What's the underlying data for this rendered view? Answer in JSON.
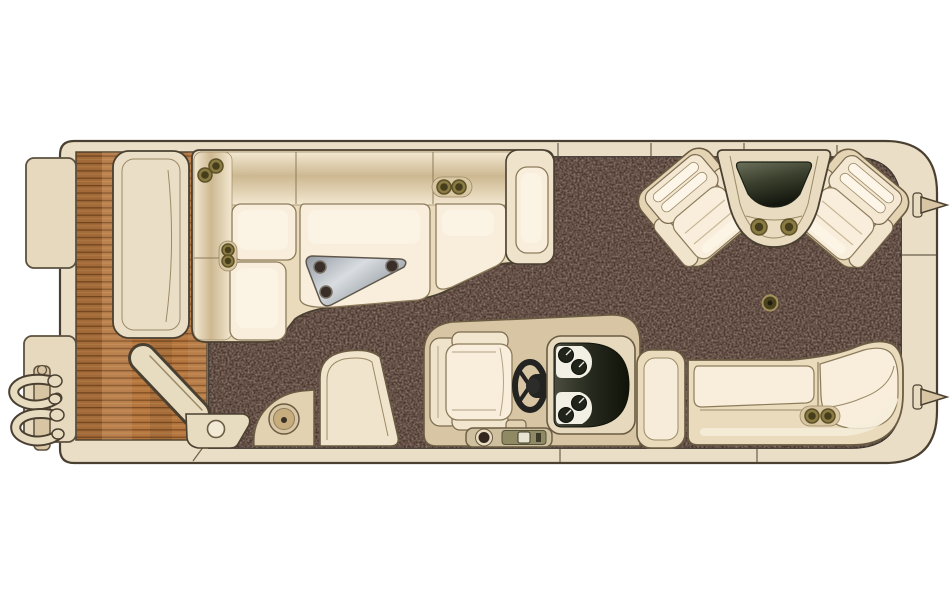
{
  "canvas": {
    "width": 950,
    "height": 615
  },
  "illustration": {
    "kind": "pontoon-boat-floor-plan-top-view",
    "parts": [
      {
        "name": "hull"
      },
      {
        "name": "bow-wood-deck"
      },
      {
        "name": "bow-gate-open"
      },
      {
        "name": "side-gate-open"
      },
      {
        "name": "gate-hinge-plate"
      },
      {
        "name": "bow-boarding-gates"
      },
      {
        "name": "boarding-ladder"
      },
      {
        "name": "bow-l-lounge"
      },
      {
        "name": "lounge-cup-holders"
      },
      {
        "name": "table-bracket-plate"
      },
      {
        "name": "privacy-wedge-console"
      },
      {
        "name": "ski-tow-base"
      },
      {
        "name": "helm-platform"
      },
      {
        "name": "captain-chair"
      },
      {
        "name": "steering-wheel"
      },
      {
        "name": "instrument-panel"
      },
      {
        "name": "throttle-panel"
      },
      {
        "name": "aft-bench"
      },
      {
        "name": "aft-cup-holders"
      },
      {
        "name": "port-aft-recliner"
      },
      {
        "name": "starboard-aft-recliner"
      },
      {
        "name": "stern-corner-console"
      },
      {
        "name": "console-cup-holders"
      },
      {
        "name": "table-floor-mount"
      },
      {
        "name": "stern-cleats"
      },
      {
        "name": "interior-carpet"
      },
      {
        "name": "deck-rails"
      }
    ]
  },
  "colors": {
    "background": "#ffffff",
    "outline": "#4a4031",
    "hull": "#eadfc6",
    "hull_shadow": "#d6c7a4",
    "wood": "#b5773f",
    "wood_line": "#7e4c22",
    "wood_light": "#cf9a5e",
    "carpet": "#4a362d",
    "carpet_speckle": "#6e574a",
    "cushion_light": "#f8eedb",
    "cushion_mid": "#efe3cc",
    "cushion_base": "#e9dbbc",
    "backrest_dark": "#cdb891",
    "seat_stroke": "#8d7c5c",
    "metal_light": "#d9dde1",
    "metal_dark": "#8b939a",
    "hole_dark": "#3a2f28",
    "dash_dark": "#33362b",
    "dash_deep": "#15170e",
    "pod_white": "#f2efe4",
    "gauge_face": "#20241b",
    "needle": "#e9e9df",
    "wheel": "#232321",
    "glass_dark": "#171b10",
    "glass_light": "#6a705a",
    "cup_ring": "#a4925c",
    "cup_fill": "#8a7b43",
    "cup_dark": "#453d1c",
    "helm_platform": "#d8c5a3",
    "throttle_panel": "#cfc0a0",
    "throttle_base": "#8f8a64",
    "knob_dark": "#32261e"
  }
}
